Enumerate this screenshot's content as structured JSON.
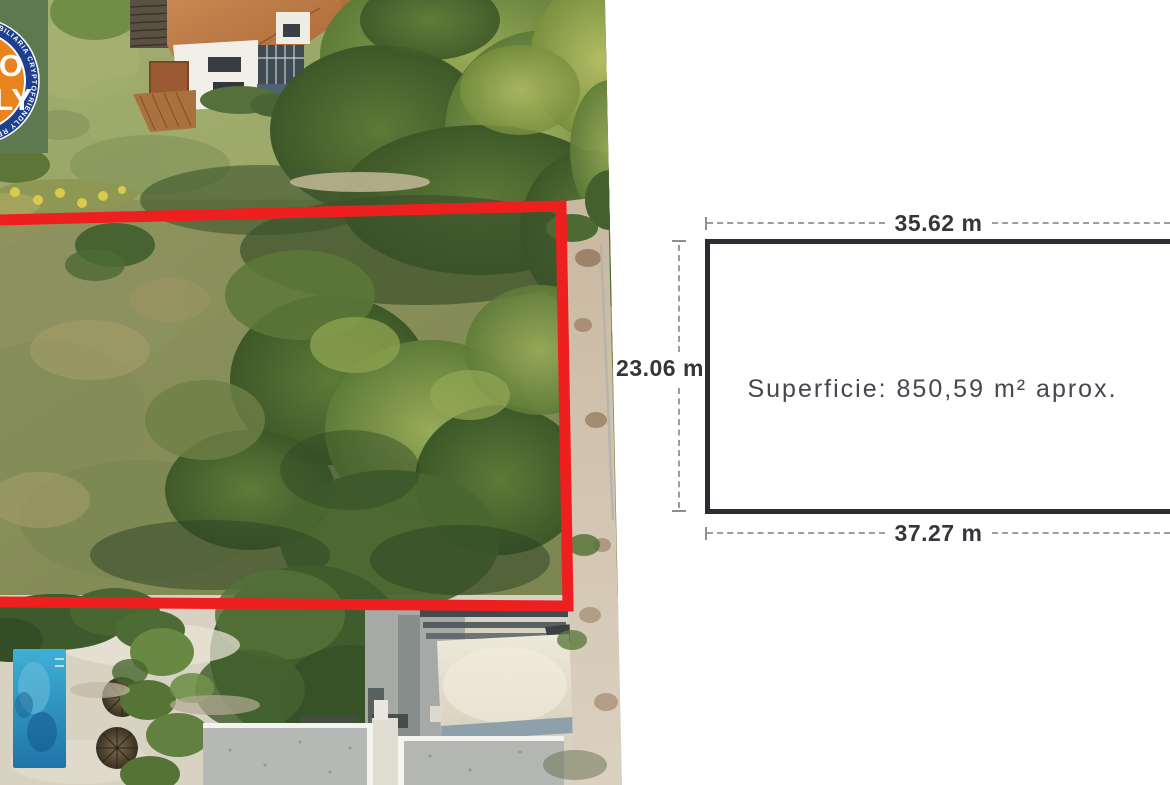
{
  "watermark": {
    "ring_text": "INMOBILIARIA CRYPTOFRIENDLY REAL ESTATE • INMOBILIARIA CRYPTOFRIENDLY REAL ESTATE • ",
    "center_word_top": "CRYPTO",
    "center_word_bottom": "FRIENDLY",
    "colors": {
      "square_green": "#5c7950",
      "ring_blue": "#1d3f8e",
      "center_orange": "#e8831d",
      "text_white": "#ffffff"
    }
  },
  "photo": {
    "plot_outline_color": "#ee1f1f"
  },
  "diagram": {
    "width_top_label": "35.62 m",
    "height_left_label": "23.06 m",
    "width_bottom_label": "37.27 m",
    "area_label": "Superficie: 850,59 m² aprox.",
    "outline_color": "#2a2e32",
    "dash_color": "#9c9c9c",
    "label_color": "#33373b"
  }
}
